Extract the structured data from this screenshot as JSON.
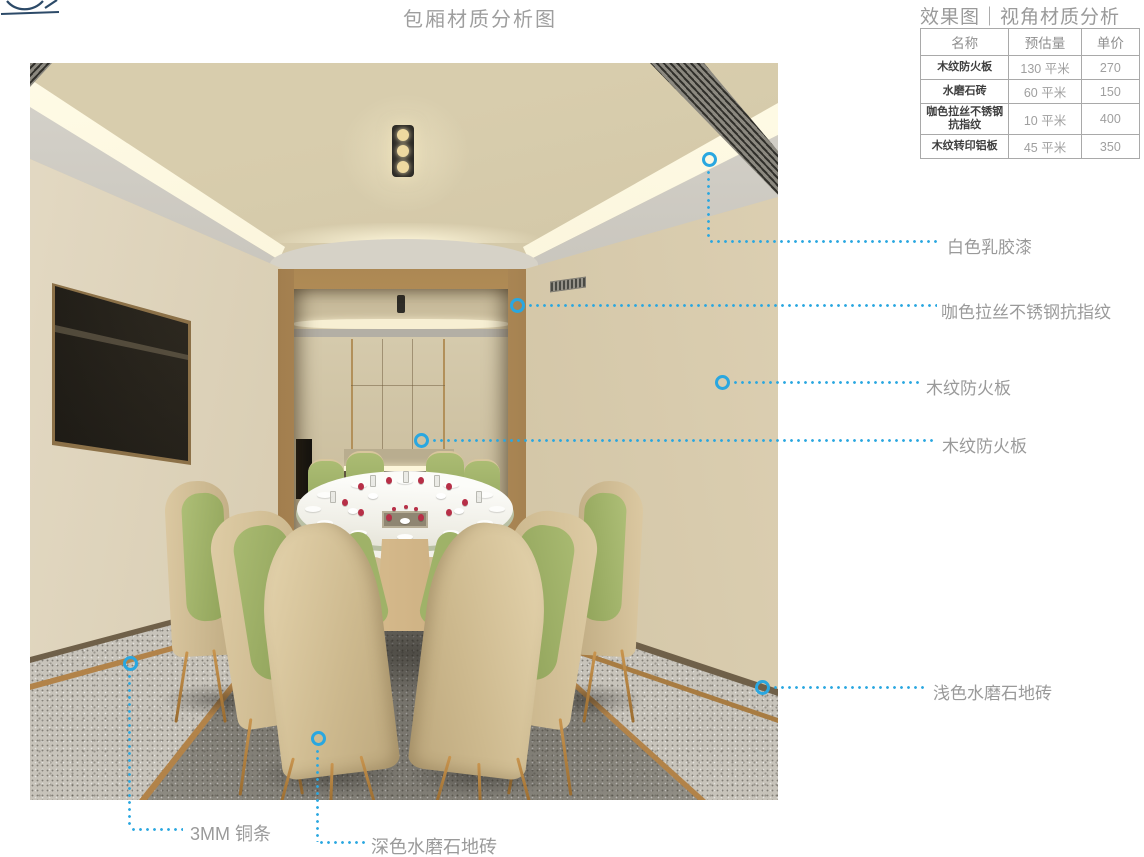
{
  "header": {
    "title": "包厢材质分析图",
    "subtitle": "效果图｜视角材质分析"
  },
  "materials_table": {
    "headers": [
      "名称",
      "预估量",
      "单价"
    ],
    "rows": [
      {
        "name": "木纹防火板",
        "qty": "130 平米",
        "price": "270"
      },
      {
        "name": "水磨石砖",
        "qty": "60 平米",
        "price": "150"
      },
      {
        "name": "咖色拉丝不锈钢抗指纹",
        "qty": "10 平米",
        "price": "400"
      },
      {
        "name": "木纹转印铝板",
        "qty": "45 平米",
        "price": "350"
      }
    ]
  },
  "annotations": {
    "right": [
      {
        "label": "白色乳胶漆"
      },
      {
        "label": "咖色拉丝不锈钢抗指纹"
      },
      {
        "label": "木纹防火板"
      },
      {
        "label": "木纹防火板"
      },
      {
        "label": "浅色水磨石地砖"
      }
    ],
    "bottom": [
      {
        "label": "3MM 铜条"
      },
      {
        "label": "深色水磨石地砖"
      }
    ]
  },
  "colors": {
    "accent_blue": "#2aa7e0",
    "label_grey": "#9a9a9a"
  }
}
